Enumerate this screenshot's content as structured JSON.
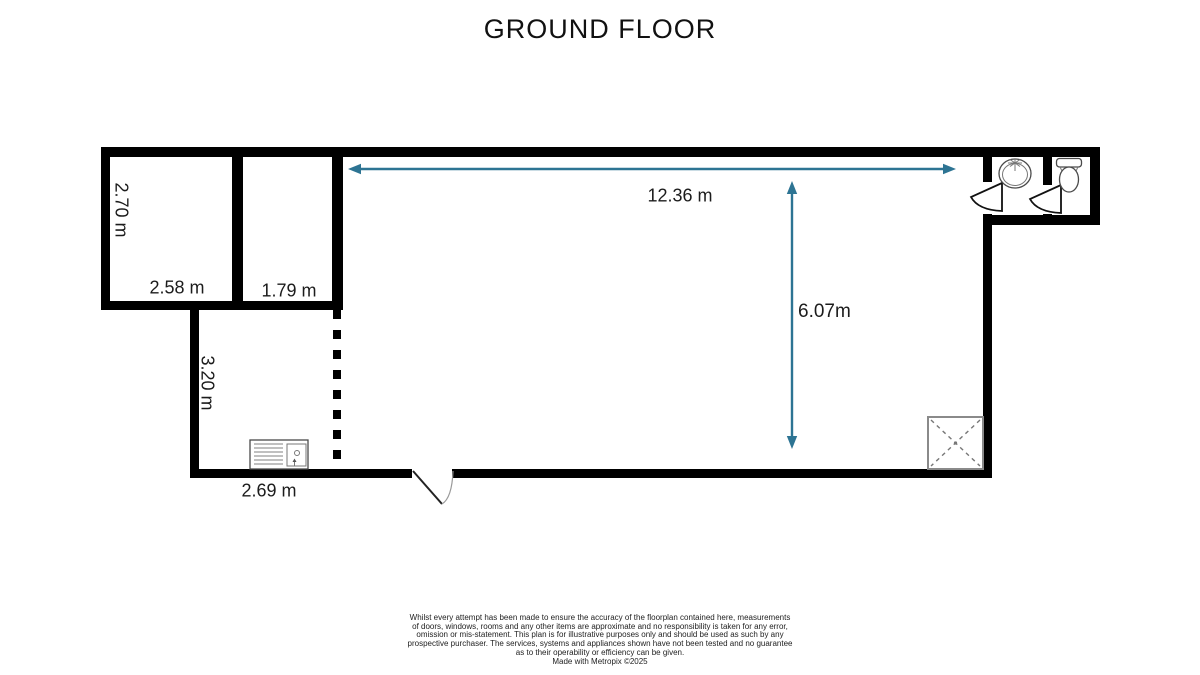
{
  "title": "GROUND FLOOR",
  "colors": {
    "dimension_arrow": "#2d7493",
    "wall": "#000000"
  },
  "dimensions": {
    "room1_height": "2.70 m",
    "room1_width": "2.58 m",
    "room2_width": "1.79 m",
    "lower_room_height": "3.20 m",
    "lower_room_width": "2.69 m",
    "main_room_width": "12.36 m",
    "main_room_height": "6.07m"
  },
  "fixtures": {
    "basin": "wash-basin",
    "toilet": "toilet",
    "kitchen_sink": "kitchen-sink-drainer",
    "shower": "shower-tray",
    "doors": "door-swing"
  },
  "disclaimer": "Whilst every attempt has been made to ensure the accuracy of the floorplan contained here, measurements\nof doors, windows, rooms and any other items are approximate and no responsibility is taken for any error,\nomission or mis-statement. This plan is for illustrative purposes only and should be used as such by any\nprospective purchaser. The services, systems and appliances shown have not been tested and no guarantee\nas to their operability or efficiency can be given.\nMade with Metropix ©2025"
}
